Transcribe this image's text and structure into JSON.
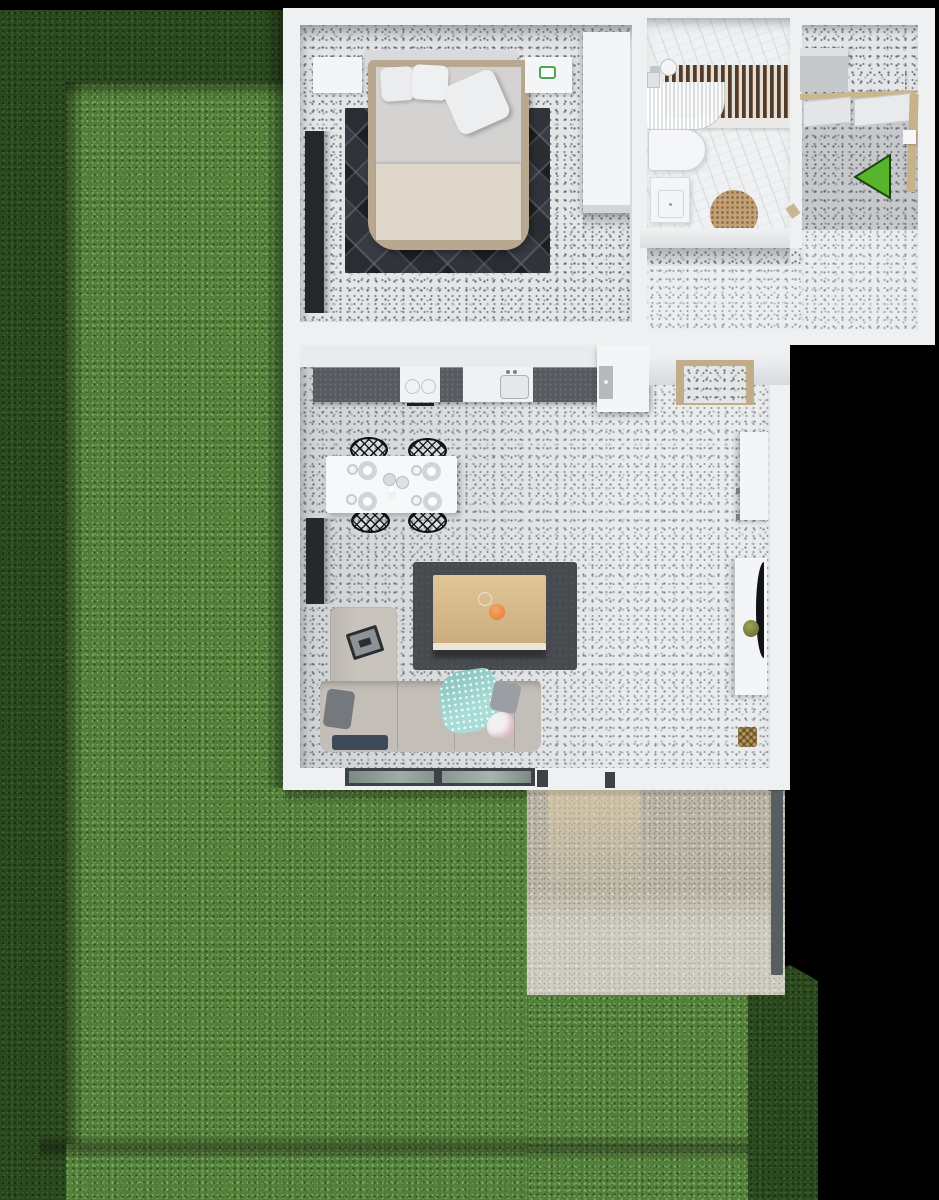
{
  "scene": {
    "kind": "3d-floor-plan-top-down-render",
    "rooms": [
      "garden-lawn",
      "bedroom",
      "bathroom",
      "entry-hall",
      "hallway",
      "living-kitchen",
      "patio"
    ],
    "icons": {
      "entrance_arrow": {
        "shape": "left-pointing-triangle",
        "color": "#58b42c",
        "outline": "#1c440f"
      }
    },
    "palette": {
      "background": "#000000",
      "grass": "#54823a",
      "hedge": "#2a481d",
      "wall": "#eef0f2",
      "terrazzo_floor": "#e3e5e7",
      "marble_floor": "#eff1f2",
      "kitchen_counter": "#565b5f",
      "sofa": "#c4beb8",
      "living_rug": "#474a4e",
      "bedroom_rug": "#1d1f23",
      "bed_frame": "#b7a88f",
      "coffee_table_wood": "#d5ba8d",
      "shower_slats_wood": "#523b2b",
      "patio": "#bdb8a9",
      "window_glass": "#7d8b83",
      "accent_orange_bowl": "#e8873c"
    }
  }
}
